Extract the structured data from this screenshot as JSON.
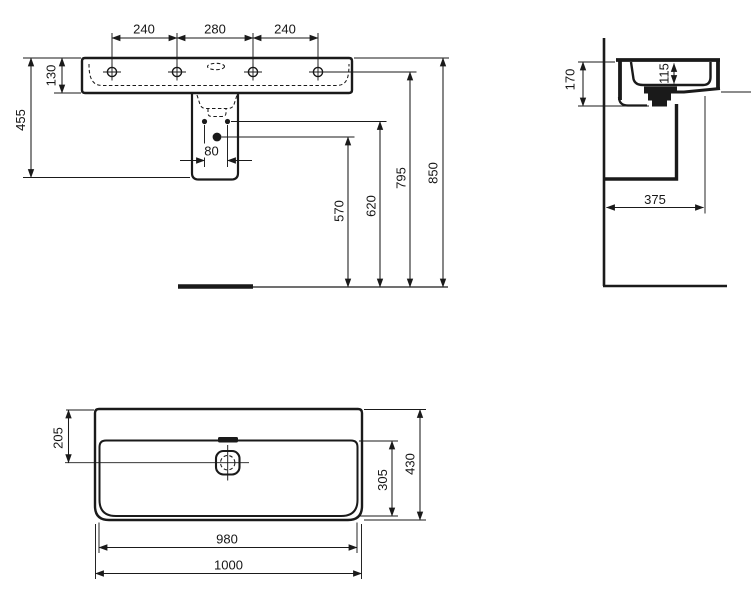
{
  "drawing": {
    "background": "#ffffff",
    "line_color": "#1a1a1a",
    "front_view": {
      "tap_spacing_left": "240",
      "tap_spacing_center": "280",
      "tap_spacing_right": "240",
      "rim_thickness": "130",
      "basin_unit_height": "455",
      "fixing_hole_spacing": "80",
      "outlet_height": "570",
      "fixing_holes_height": "620",
      "taphole_height": "795",
      "rim_height": "850"
    },
    "side_view": {
      "front_edge_depth": "170",
      "inner_bowl_depth": "115",
      "wall_projection": "375"
    },
    "plan_view": {
      "drain_centre_from_back": "205",
      "bowl_section_depth": "305",
      "overall_depth": "430",
      "inner_width": "980",
      "overall_width": "1000"
    }
  }
}
